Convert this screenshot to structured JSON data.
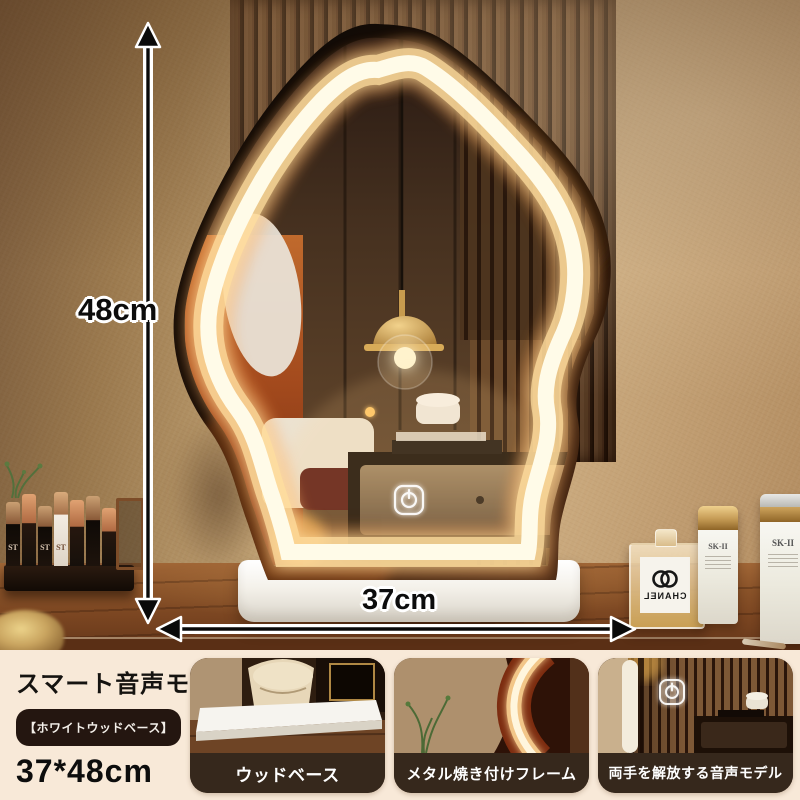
{
  "photo": {
    "dimensions": {
      "height_label": "48cm",
      "width_label": "37cm"
    },
    "brands": {
      "lipstick": "ST",
      "perfume": "CHANEL",
      "skincare": "SK-II"
    }
  },
  "info": {
    "title": "スマート音声モデル",
    "variant_badge": "【ホワイトウッドベース】",
    "size": "37*48cm"
  },
  "thumbnails": [
    {
      "caption": "ウッドベース"
    },
    {
      "caption": "メタル焼き付けフレーム"
    },
    {
      "caption": "両手を解放する音声モデル"
    }
  ],
  "colors": {
    "strip_bg": "#f8e9d8",
    "caption_bg": "#36281c",
    "badge_bg": "#241610",
    "led_glow": "#ffe9b8",
    "wall": "#c4a378",
    "desk_wood": "#7a4521",
    "mirror_frame": "#140c06"
  }
}
